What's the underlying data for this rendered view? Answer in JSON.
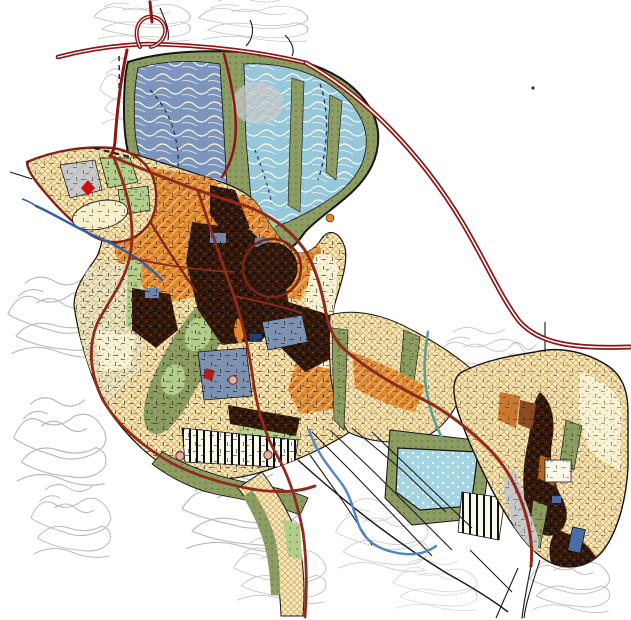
{
  "map": {
    "type": "zoning-plan-map",
    "canvas": {
      "width": 631,
      "height": 620
    },
    "colors": {
      "background": "#ffffff",
      "outline": "#141414",
      "highway": "#8c1515",
      "highway_core": "#ffffff",
      "road": "#8f2a1c",
      "road_minor": "#7e2418",
      "orange_zone": "#e0892e",
      "orange_hatch": "#ffffff",
      "cream_zone": "#f3e9c3",
      "cream_hatch": "#d4a44c",
      "cream_dark": "#efe5bd",
      "cream_dark_hatch": "#555555",
      "pale_zone": "#f8f3d6",
      "pale_dot": "#c9b66a",
      "olive_zone": "#8d9c63",
      "olive_dot": "#5f6d3a",
      "green_zone": "#b3cd8c",
      "green_dot": "#6f8f4a",
      "slate_zone": "#7d92af",
      "navy": "#24406e",
      "blue_left_zone": "#7e95bb",
      "blue_right_zone": "#97c8da",
      "contour_white": "#ffffff",
      "lake": "#a5d4e2",
      "lake_dot": "#ffffff",
      "dark_zone": "#331a0c",
      "dark_speck": "#000000",
      "dark_brown": "#7a3b1e",
      "gray_zone": "#c9c9c9",
      "gray_line": "#9a9a9a",
      "contour_gray": "#b9b9b9",
      "contour_light": "#d2d2d2",
      "river": "#2f5fa8",
      "stream": "#4f86c6",
      "stream_teal": "#5f9e8f",
      "landmark_red": "#cc1111",
      "building_blue": "#4a6da8",
      "junction_dot": "#d8b2a8",
      "stripe_bg": "#fbf8ec",
      "stripe_black": "#111111",
      "speck_black": "#000000"
    },
    "features": [
      {
        "id": "motorway-ring",
        "kind": "double-line highway"
      },
      {
        "id": "north-hillside-blue-zones",
        "kind": "hatched protection zones"
      },
      {
        "id": "central-urban-area",
        "kind": "mixed orange/cream built-up zones"
      },
      {
        "id": "old-town-core",
        "kind": "dark dense historic core"
      },
      {
        "id": "west-promontory",
        "kind": "parcelled spur with red diamond landmark"
      },
      {
        "id": "river",
        "kind": "blue watercourse"
      },
      {
        "id": "southern-stream",
        "kind": "blue watercourse"
      },
      {
        "id": "east-settlement",
        "kind": "village with dark core"
      },
      {
        "id": "southeast-lake-zone",
        "kind": "stippled blue water area"
      },
      {
        "id": "terrain-contours",
        "kind": "gray contour line clusters"
      }
    ]
  }
}
